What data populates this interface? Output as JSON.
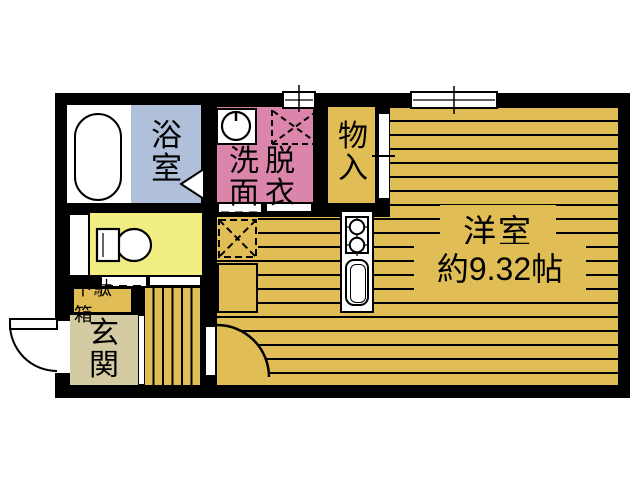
{
  "colors": {
    "wall": "#000000",
    "gold": "#e0be55",
    "pink": "#db85ab",
    "blue": "#b0c0db",
    "yellow": "#f0ee83",
    "beige": "#d5cba3"
  },
  "rooms": {
    "bathroom": {
      "label": "浴室"
    },
    "washroom": {
      "label": "洗面脱衣",
      "column_left": "洗面",
      "column_right": "脱衣"
    },
    "storage": {
      "label": "物入"
    },
    "western_room": {
      "label": "洋室",
      "size": "約9.32帖"
    },
    "entrance": {
      "label": "玄関"
    },
    "shoe_cabinet": {
      "label": "下駄箱"
    }
  }
}
